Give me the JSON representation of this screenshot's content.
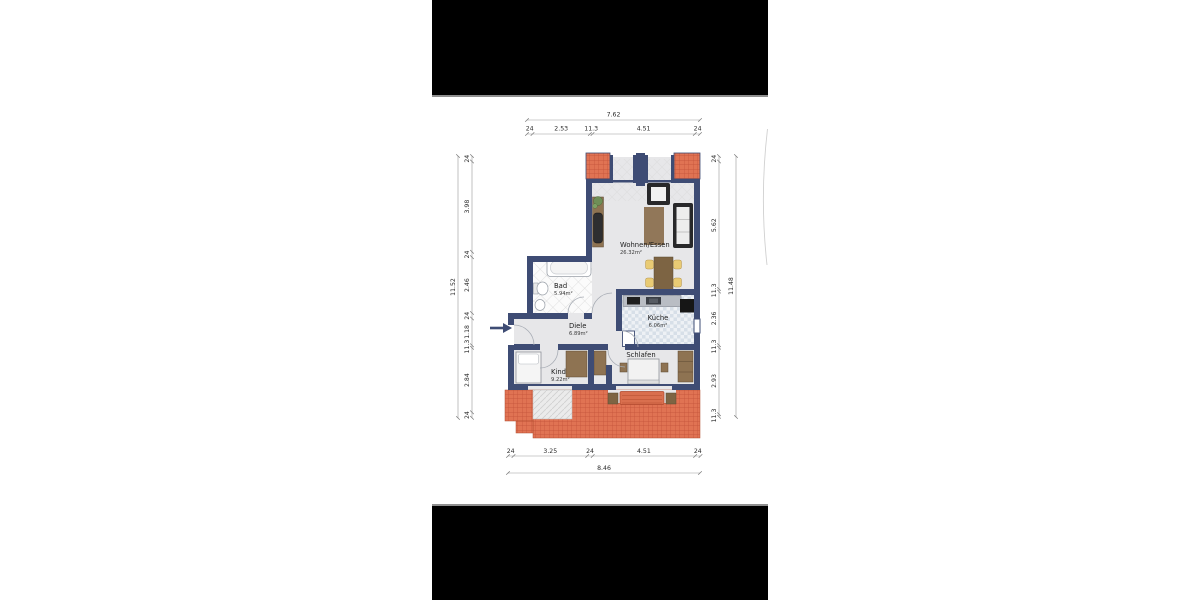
{
  "plan": {
    "rooms": [
      {
        "name": "Wohnen/Essen",
        "area": "26.32m²"
      },
      {
        "name": "Küche",
        "area": "6.06m²"
      },
      {
        "name": "Bad",
        "area": "5.94m²"
      },
      {
        "name": "Diele",
        "area": "6.89m²"
      },
      {
        "name": "Kind",
        "area": "9.22m²"
      },
      {
        "name": "Schlafen",
        "area": ""
      }
    ],
    "dimensions": {
      "top": {
        "total": "7.62",
        "segments": [
          "24",
          "2.53",
          "11.3",
          "4.51",
          "24"
        ]
      },
      "bottom": {
        "total": "8.46",
        "segments": [
          "24",
          "3.25",
          "24",
          "4.51",
          "24"
        ]
      },
      "left": {
        "total": "11.52",
        "segments": [
          "24",
          "3.98",
          "24",
          "2.46",
          "24",
          "1.18",
          "11.3",
          "2.84",
          "24"
        ]
      },
      "right": {
        "total": "11.48",
        "segments": [
          "24",
          "5.62",
          "11.3",
          "2.36",
          "11.3",
          "2.93",
          "11.3"
        ]
      }
    },
    "colors": {
      "wall": "#3e4c74",
      "brick": "#e07353",
      "floor": "#e7e7e9",
      "letterbox": "#000000"
    }
  }
}
